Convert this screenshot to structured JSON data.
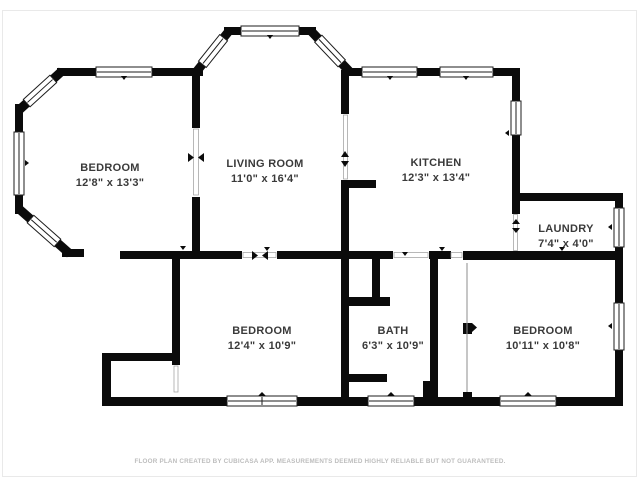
{
  "colors": {
    "wall": "#0b0b0b",
    "label_text": "#3a3a3a",
    "footer_text": "#bdbdbd",
    "background": "#ffffff"
  },
  "rooms": [
    {
      "id": "bedroom-1",
      "name": "BEDROOM",
      "dims": "12'8\" x 13'3\""
    },
    {
      "id": "living-room",
      "name": "LIVING ROOM",
      "dims": "11'0\" x 16'4\""
    },
    {
      "id": "kitchen",
      "name": "KITCHEN",
      "dims": "12'3\" x 13'4\""
    },
    {
      "id": "laundry",
      "name": "LAUNDRY",
      "dims": "7'4\" x 4'0\""
    },
    {
      "id": "bedroom-2",
      "name": "BEDROOM",
      "dims": "12'4\" x 10'9\""
    },
    {
      "id": "bath",
      "name": "BATH",
      "dims": "6'3\" x 10'9\""
    },
    {
      "id": "bedroom-3",
      "name": "BEDROOM",
      "dims": "10'11\" x 10'8\""
    }
  ],
  "footer": {
    "text": "FLOOR PLAN CREATED BY CUBICASA APP. MEASUREMENTS DEEMED HIGHLY RELIABLE BUT NOT GUARANTEED."
  }
}
